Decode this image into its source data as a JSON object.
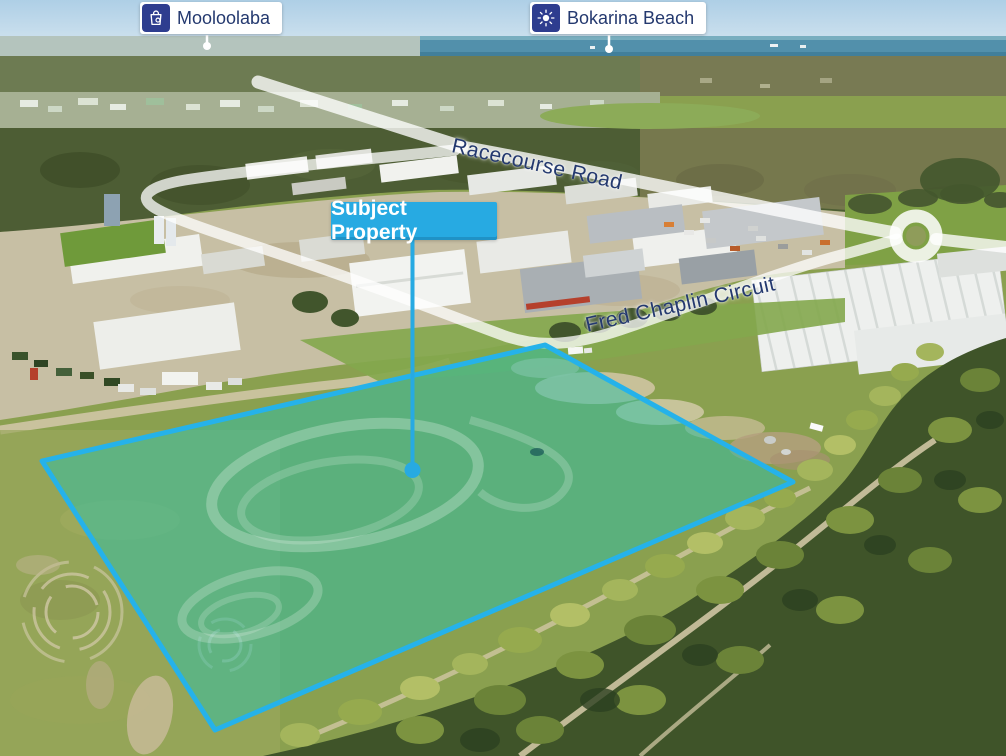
{
  "map_labels": {
    "poi": [
      {
        "label": "Mooloolaba",
        "icon": "shopping-bag-icon"
      },
      {
        "label": "Bokarina Beach",
        "icon": "sun-icon"
      }
    ],
    "roads": [
      {
        "label": "Racecourse Road"
      },
      {
        "label": "Fred Chaplin Circuit"
      }
    ],
    "subject": {
      "label": "Subject Property"
    }
  },
  "colors": {
    "accent-cyan": "#27aae2",
    "boundary-cyan": "#25b2ea",
    "property-fill": "#2fbfa6",
    "label-navy": "#24396f",
    "badge-navy": "#2e3d8f",
    "label-bg": "#ffffff"
  }
}
